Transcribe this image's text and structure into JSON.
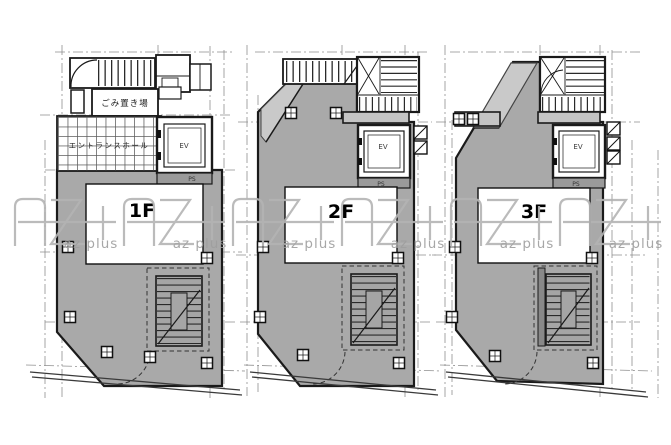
{
  "page": {
    "background": "#ffffff",
    "kind": "architectural floor plan sheet"
  },
  "drawing": {
    "colors": {
      "floor_fill": "#a9a9a9",
      "roof_fill": "#c9c9c9",
      "stair_fill": "#a5a5a5",
      "slab_fill": "#c4c4c4",
      "ps_fill": "#9a9a9a",
      "line": "#1a1a1a",
      "grid_line": "#8f8f8f"
    },
    "floors": [
      {
        "id": "1f",
        "label": "1F",
        "rooms": [
          {
            "name": "ごみ置き場"
          },
          {
            "name": "エントランスホール"
          },
          {
            "name": "EV"
          },
          {
            "name": "PS"
          }
        ]
      },
      {
        "id": "2f",
        "label": "2F",
        "rooms": [
          {
            "name": "EV"
          },
          {
            "name": "PS"
          }
        ]
      },
      {
        "id": "3f",
        "label": "3F",
        "rooms": [
          {
            "name": "EV"
          },
          {
            "name": "PS"
          }
        ]
      }
    ]
  },
  "watermark": {
    "brand": "AZ+",
    "small_text": "az plus",
    "repeat_count": 6,
    "color": "#b4b4b4",
    "text_color": "#9e9e9e"
  }
}
